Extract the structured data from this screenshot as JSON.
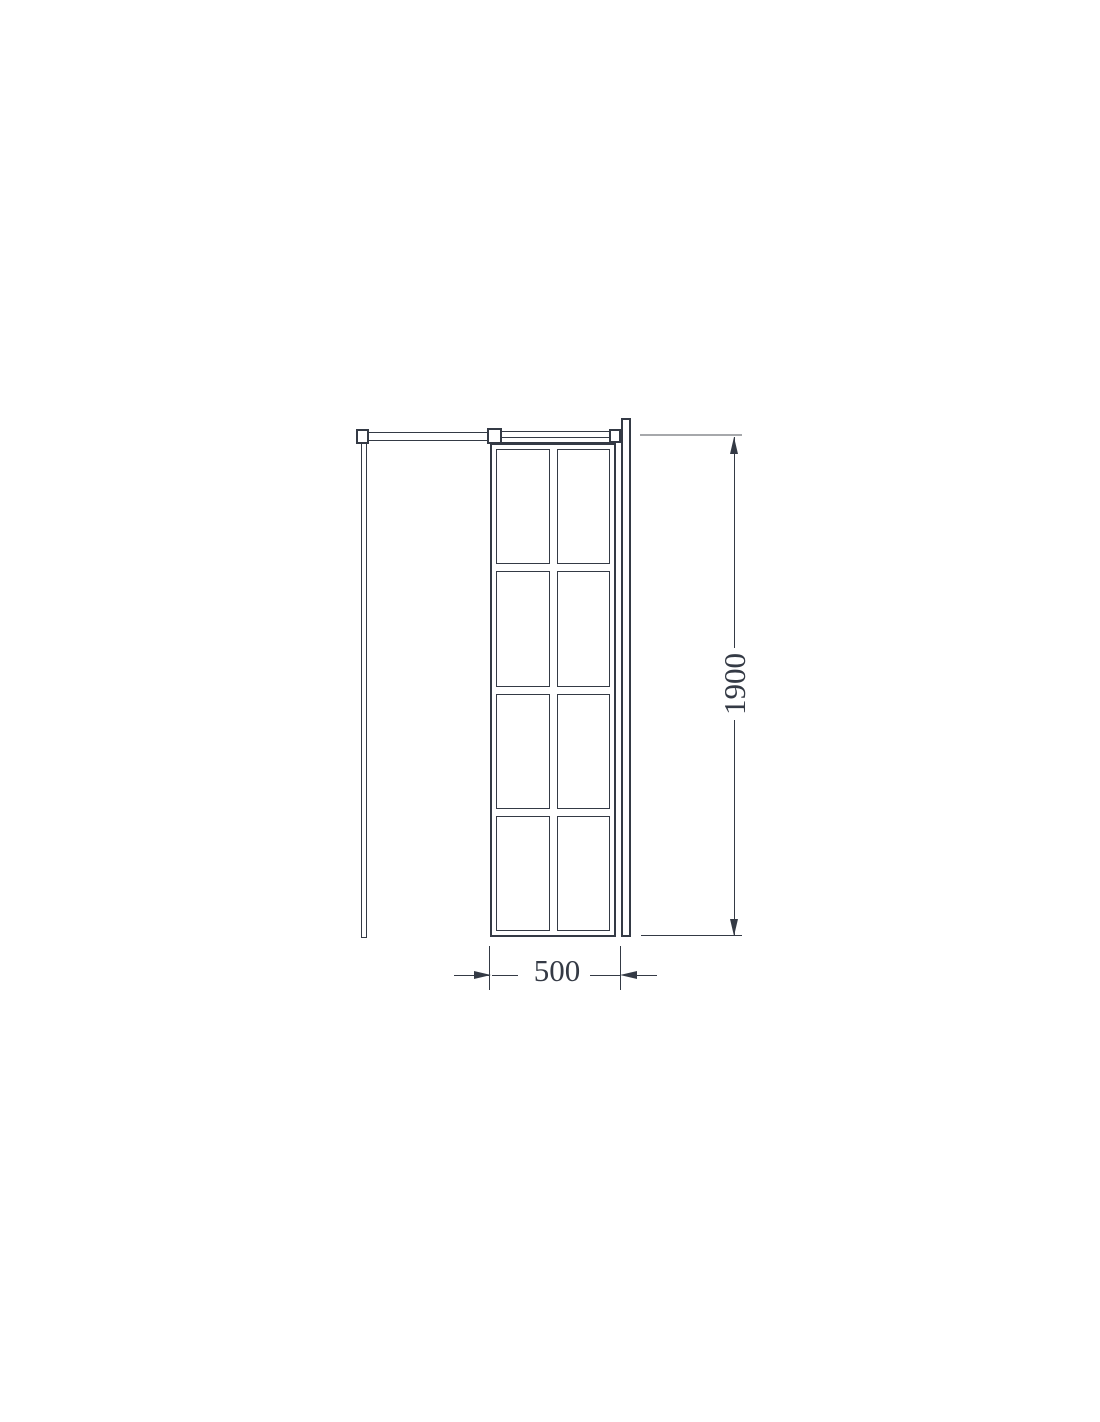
{
  "diagram": {
    "type": "technical-drawing",
    "subject": "framed glass shower panel with support bar and wall profile",
    "panel": {
      "grid_columns": 2,
      "grid_rows": 4,
      "pane_count": 8
    },
    "dimensions": {
      "width": {
        "label": "500"
      },
      "height": {
        "label": "1900"
      }
    },
    "colors": {
      "line": "#343a45",
      "extension_gray": "#a6a8ab",
      "background": "#ffffff"
    }
  }
}
